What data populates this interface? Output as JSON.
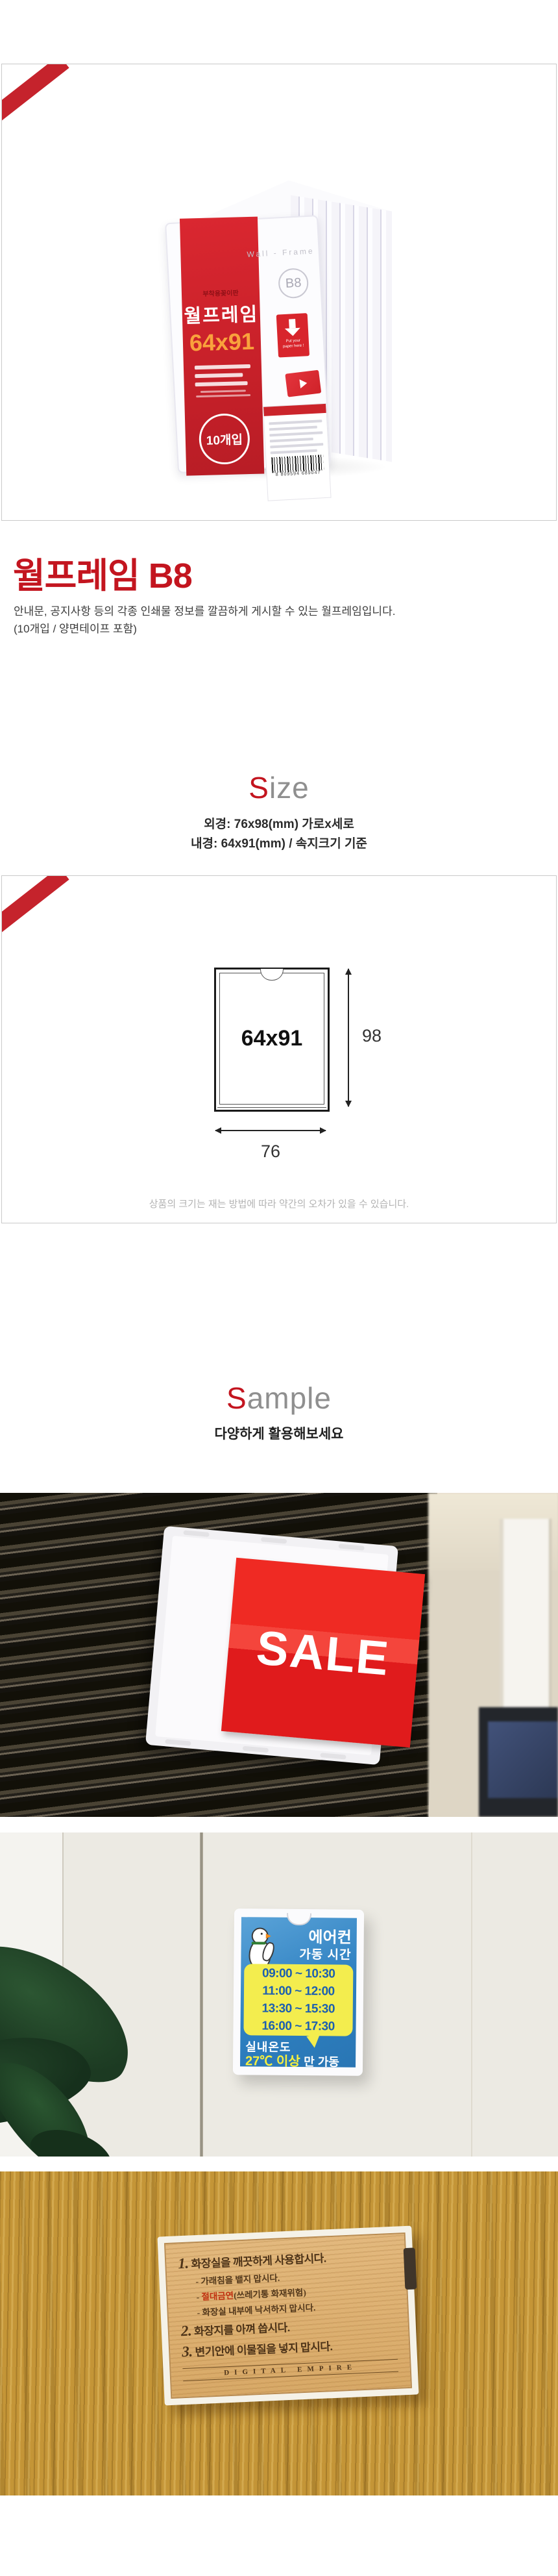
{
  "product": {
    "title": "월프레임 B8",
    "description_line1": "안내문, 공지사항 등의 각종 인쇄물 정보를 깔끔하게 게시할 수 있는 월프레임입니다.",
    "description_line2": "(10개입 / 양면테이프 포함)",
    "package": {
      "small_label": "부착용꽂이판",
      "name": "월프레임",
      "size": "64x91",
      "count_badge": "10개입",
      "wall_frame_text": "Wall - Frame",
      "model_badge": "B8",
      "arrow_note_line1": "Put your",
      "arrow_note_line2": "paper here !",
      "barcode_number": "8 809594 689047"
    }
  },
  "size_section": {
    "heading_first": "S",
    "heading_rest": "ize",
    "outer_spec": "외경: 76x98(mm) 가로x세로",
    "inner_spec": "내경: 64x91(mm) / 속지크기 기준",
    "diagram": {
      "inner_label": "64x91",
      "height_label": "98",
      "width_label": "76"
    },
    "note": "상품의 크기는 재는 방법에 따라 약간의 오차가 있을 수 있습니다."
  },
  "sample_section": {
    "heading_first": "S",
    "heading_rest": "ample",
    "subtitle": "다양하게 활용해보세요",
    "photo1": {
      "sign_text": "SALE"
    },
    "photo2": {
      "line1": "에어컨",
      "line2": "가동 시간",
      "times": [
        "09:00 ~ 10:30",
        "11:00 ~ 12:00",
        "13:30 ~ 15:30",
        "16:00 ~ 17:30"
      ],
      "temp_label": "실내온도",
      "temp_value": "27℃ 이상",
      "temp_suffix": "만 가동"
    },
    "photo3": {
      "rule1_num": "1.",
      "rule1": "화장실을 깨끗하게 사용합시다.",
      "sub1": "- 가래침을 뱉지 맙시다.",
      "sub2_prefix": "- ",
      "sub2_red": "절대금연",
      "sub2_rest": "(쓰레기통 화재위험)",
      "sub3": "- 화장실 내부에 낙서하지 맙시다.",
      "rule2_num": "2.",
      "rule2": "화장지를 아껴 씁시다.",
      "rule3_num": "3.",
      "rule3": "변기안에 이물질을 넣지 맙시다.",
      "brand": "DIGITAL EMPIRE"
    }
  },
  "colors": {
    "accent_red": "#c5232c",
    "title_red": "#c3151f",
    "sign_blue": "#2d7fc0",
    "bubble_yellow": "#f3ed4e",
    "wood": "#c49537"
  }
}
